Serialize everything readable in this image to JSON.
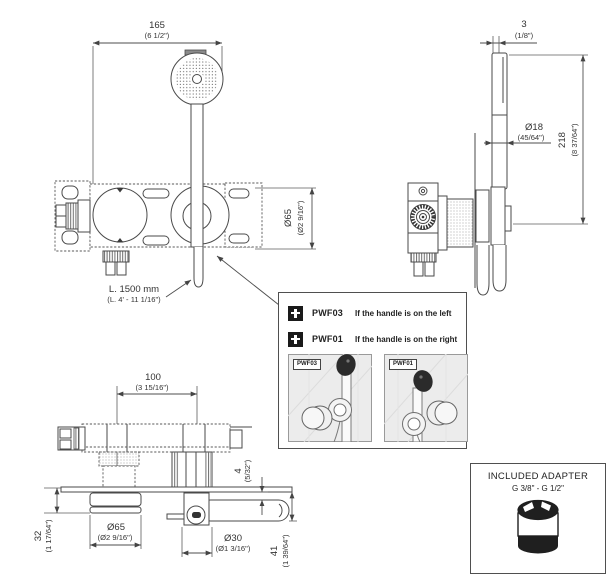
{
  "drawing": {
    "front_view": {
      "dim_width": {
        "mm": "165",
        "in": "(6 1/2\")"
      },
      "dim_diameter": {
        "mm": "Ø65",
        "in": "(Ø2 9/16\")"
      },
      "hose_length": {
        "mm": "L. 1500 mm",
        "in": "(L. 4' - 11 1/16\")"
      }
    },
    "side_view": {
      "dim_thickness": {
        "mm": "3",
        "in": "(1/8\")"
      },
      "dim_handle_diameter": {
        "mm": "Ø18",
        "in": "(45/64\")"
      },
      "dim_height": {
        "mm": "218",
        "in": "(8 37/64\")"
      }
    },
    "bottom_view": {
      "dim_spacing": {
        "mm": "100",
        "in": "(3 15/16\")"
      },
      "dim_gap": {
        "mm": "4",
        "in": "(5/32\")"
      },
      "dim_knob_depth": {
        "mm": "32",
        "in": "(1 17/64\")"
      },
      "dim_knob_diameter": {
        "mm": "Ø65",
        "in": "(Ø2 9/16\")"
      },
      "dim_lever_diameter": {
        "mm": "Ø30",
        "in": "(Ø1 3/16\")"
      },
      "dim_lever_depth": {
        "mm": "41",
        "in": "(1 39/64\")"
      }
    }
  },
  "options_panel": {
    "items": [
      {
        "code": "PWF03",
        "description": "If the handle is on the left"
      },
      {
        "code": "PWF01",
        "description": "If the handle is on the right"
      }
    ],
    "thumbnails": [
      {
        "label": "PWF03"
      },
      {
        "label": "PWF01"
      }
    ]
  },
  "adapter_panel": {
    "title": "INCLUDED ADAPTER",
    "subtitle": "G 3/8\" - G 1/2\""
  },
  "colors": {
    "line": "#4a4a4a",
    "text": "#333333",
    "badge": "#1a1a1a",
    "thumb_background": "#ececec"
  }
}
